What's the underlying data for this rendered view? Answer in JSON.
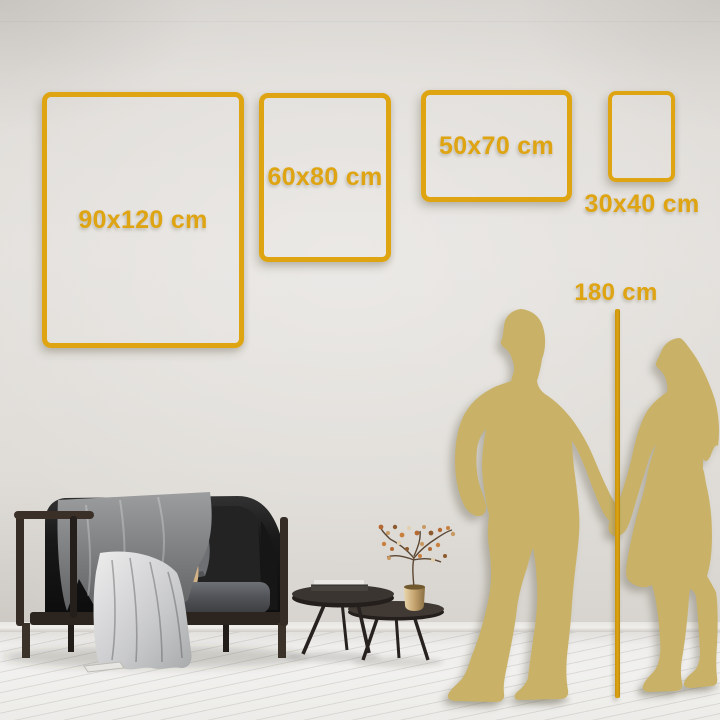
{
  "title": "Wall art size comparison guide",
  "frames": [
    {
      "id": "90x120",
      "label": "90x120 cm",
      "width_cm": 90,
      "height_cm": 120,
      "orientation": "portrait"
    },
    {
      "id": "60x80",
      "label": "60x80 cm",
      "width_cm": 60,
      "height_cm": 80,
      "orientation": "portrait"
    },
    {
      "id": "50x70",
      "label": "50x70 cm",
      "width_cm": 50,
      "height_cm": 70,
      "orientation": "landscape"
    },
    {
      "id": "30x40",
      "label": "30x40 cm",
      "width_cm": 30,
      "height_cm": 40,
      "orientation": "portrait"
    }
  ],
  "height_marker": {
    "label": "180 cm",
    "value_cm": 180
  },
  "scene_objects": {
    "silhouette": "couple holding hands",
    "furniture": [
      "dark velvet loveseat",
      "gray throw blanket",
      "gray cushion",
      "tan cushion",
      "round coffee table large",
      "round coffee table small",
      "stack of books",
      "brass vase with dried flowers"
    ]
  },
  "colors": {
    "accent_gold": "#DFA412",
    "silhouette_gold": "#C9B268",
    "wall_mid": "#E3E0DC",
    "floor": "#F1F0EE"
  }
}
